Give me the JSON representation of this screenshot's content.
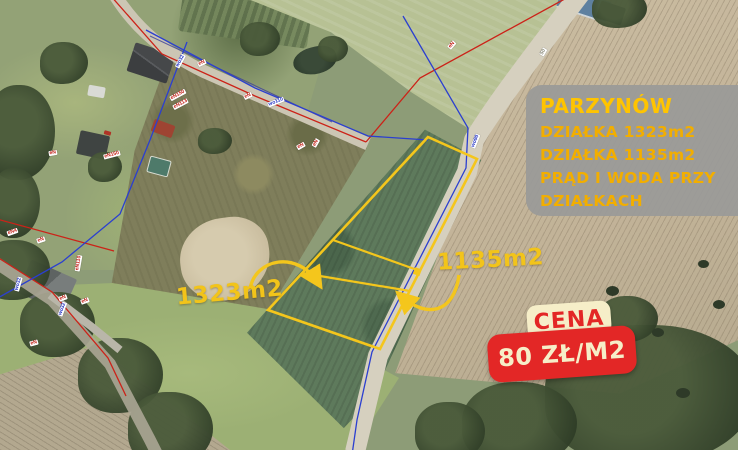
{
  "overlay": {
    "info_box": {
      "title": "PARZYNÓW",
      "lines": [
        "DZIAŁKA 1323m2",
        "DZIAŁKA 1135m2",
        "PRĄD I WODA PRZY",
        "DZIAŁKACH"
      ]
    },
    "price": {
      "label": "CENA",
      "value": "80 ZŁ/M2"
    },
    "plot_labels": [
      {
        "text": "1323m2"
      },
      {
        "text": "1135m2"
      }
    ]
  },
  "map_labels": [
    {
      "text": "wo32",
      "kind": "wo",
      "x": 172,
      "y": 58,
      "rot": -62
    },
    {
      "text": "eN",
      "kind": "eN",
      "x": 197,
      "y": 60,
      "rot": -25
    },
    {
      "text": "eN",
      "kind": "eN",
      "x": 243,
      "y": 93,
      "rot": -25
    },
    {
      "text": "wo110",
      "kind": "wo",
      "x": 266,
      "y": 99,
      "rot": -22
    },
    {
      "text": "eN",
      "kind": "eN",
      "x": 447,
      "y": 42,
      "rot": -48
    },
    {
      "text": "50",
      "kind": "misc",
      "x": 539,
      "y": 49,
      "rot": -60
    },
    {
      "text": "eN",
      "kind": "eN",
      "x": 296,
      "y": 143,
      "rot": -30
    },
    {
      "text": "eN",
      "kind": "eN",
      "x": 311,
      "y": 140,
      "rot": -60
    },
    {
      "text": "wo90",
      "kind": "wo",
      "x": 467,
      "y": 138,
      "rot": -68
    },
    {
      "text": "eN150",
      "kind": "eN",
      "x": 168,
      "y": 92,
      "rot": -28
    },
    {
      "text": "eN113",
      "kind": "eN",
      "x": 171,
      "y": 101,
      "rot": -28
    },
    {
      "text": "eN",
      "kind": "eN",
      "x": 48,
      "y": 150,
      "rot": -10
    },
    {
      "text": "eN150",
      "kind": "eN",
      "x": 102,
      "y": 152,
      "rot": -15
    },
    {
      "text": "eN4",
      "kind": "eN",
      "x": 6,
      "y": 229,
      "rot": -20
    },
    {
      "text": "eN",
      "kind": "eN",
      "x": 36,
      "y": 237,
      "rot": -18
    },
    {
      "text": "eN110",
      "kind": "eN",
      "x": 69,
      "y": 260,
      "rot": -80
    },
    {
      "text": "wo32",
      "kind": "wo",
      "x": 10,
      "y": 281,
      "rot": -75
    },
    {
      "text": "eN",
      "kind": "eN",
      "x": 58,
      "y": 295,
      "rot": -20
    },
    {
      "text": "eN",
      "kind": "eN",
      "x": 80,
      "y": 298,
      "rot": -20
    },
    {
      "text": "wo32",
      "kind": "wo",
      "x": 54,
      "y": 306,
      "rot": -70
    },
    {
      "text": "eN",
      "kind": "eN",
      "x": 29,
      "y": 340,
      "rot": -15
    }
  ],
  "colors": {
    "accent_yellow": "#f4c61c",
    "price_red": "#e32726",
    "cream": "#f6eec8",
    "info_gray": "#9a9a98",
    "utility_red": "#cc2218",
    "utility_blue": "#2b3fd0"
  }
}
